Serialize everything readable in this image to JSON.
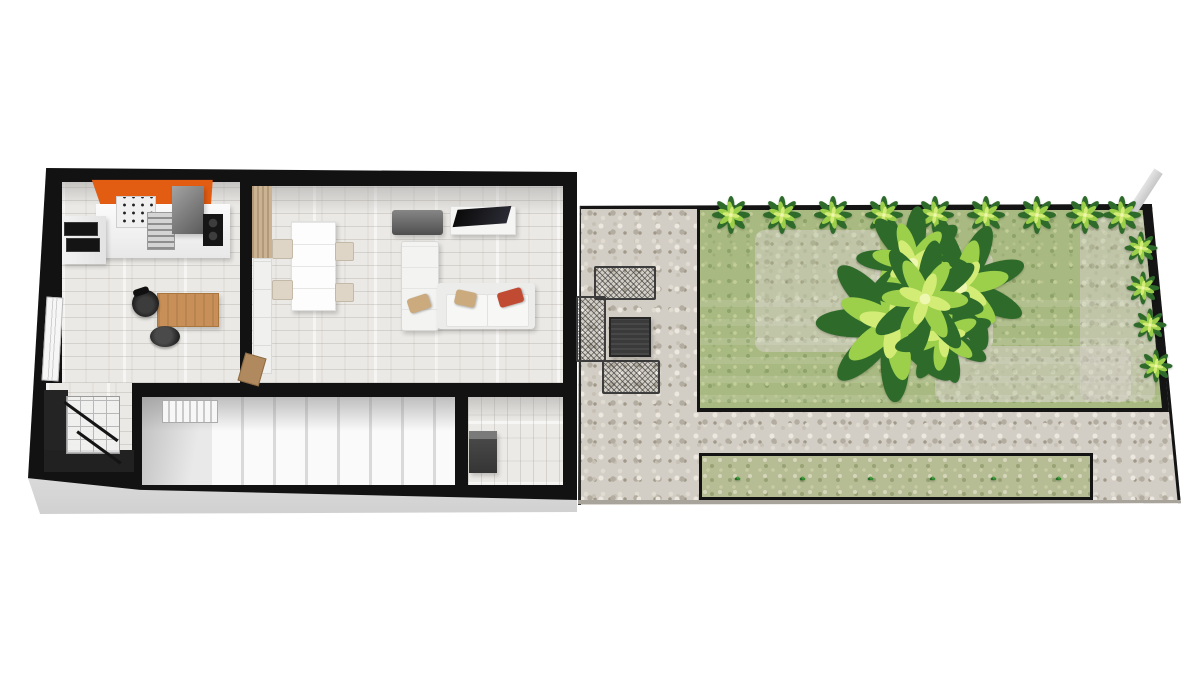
{
  "scene": {
    "type": "3d-floorplan-render",
    "background": "#ffffff"
  },
  "colors": {
    "wall": "#121212",
    "accent_orange": "#e25c12",
    "floor_light": "#ebe9e5",
    "stone": "#d3cec5",
    "lawn": "#a8b981",
    "hedge_dark": "#2e6b2a",
    "hedge_light": "#9ccf4a",
    "planter_bed": "#b6bc94",
    "furniture_dark": "#3a3a3a",
    "sofa_white": "#f3f3f2",
    "desk_wood": "#c89058",
    "pillow_red": "#c14a32",
    "pillow_tan": "#cbaa7e"
  },
  "building": {
    "rooms": [
      {
        "name": "kitchen-office"
      },
      {
        "name": "living-room"
      },
      {
        "name": "staircase-room"
      },
      {
        "name": "entry-hall"
      },
      {
        "name": "stair-nook"
      }
    ],
    "objects": [
      "kitchen-counter",
      "cooktop-left",
      "stove",
      "dish-rack",
      "fridge",
      "black-cooktop",
      "desk",
      "office-chair",
      "stool",
      "window-left-wall",
      "dining-table",
      "dining-chairs",
      "wardrobe-panel",
      "white-cabinet",
      "gray-sideboard",
      "tv-console",
      "tv",
      "chaise-longue",
      "sofa",
      "pillows",
      "stair-glass-railing",
      "stair-treads",
      "radiator",
      "shoe-cabinet",
      "interior-door"
    ]
  },
  "garden": {
    "objects": [
      "patio-table",
      "garden-bench-top",
      "garden-bench-left",
      "garden-bench-bottom",
      "boundary-wall-stub"
    ],
    "hedge": {
      "count": 9,
      "x": [
        731,
        782,
        833,
        884,
        935,
        986,
        1037,
        1085,
        1122
      ],
      "y": 215
    },
    "edge_bushes": [
      [
        1141,
        248
      ],
      [
        1143,
        288
      ],
      [
        1150,
        325
      ],
      [
        1156,
        366
      ]
    ],
    "planter": {
      "tuft_x": [
        737,
        802,
        870,
        932,
        993,
        1058
      ],
      "tuft_y": 478
    },
    "tree": {
      "x": 925,
      "y": 299,
      "size": 120
    }
  }
}
